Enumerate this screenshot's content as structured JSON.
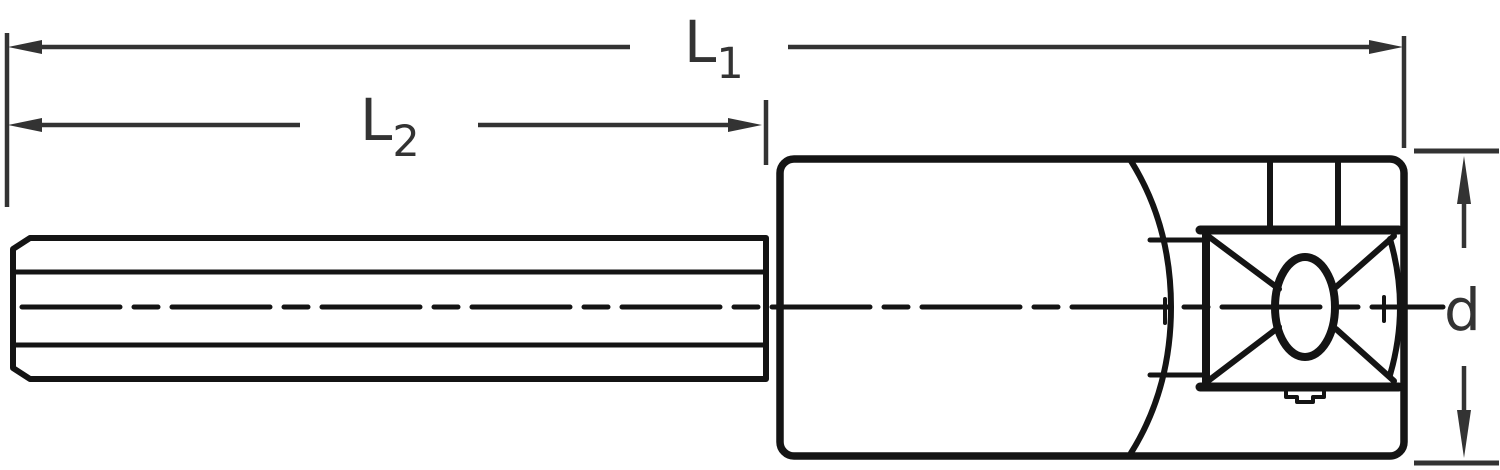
{
  "drawing": {
    "title": "hex-shank socket side elevation with sectioned drive end",
    "labels": {
      "l1": {
        "base": "L",
        "sub": "1"
      },
      "l2": {
        "base": "L",
        "sub": "2"
      },
      "d": {
        "base": "d"
      }
    },
    "colors": {
      "background": "#ffffff",
      "outline": "#141414",
      "dimension": "#333333",
      "hatch": "#141414"
    }
  }
}
